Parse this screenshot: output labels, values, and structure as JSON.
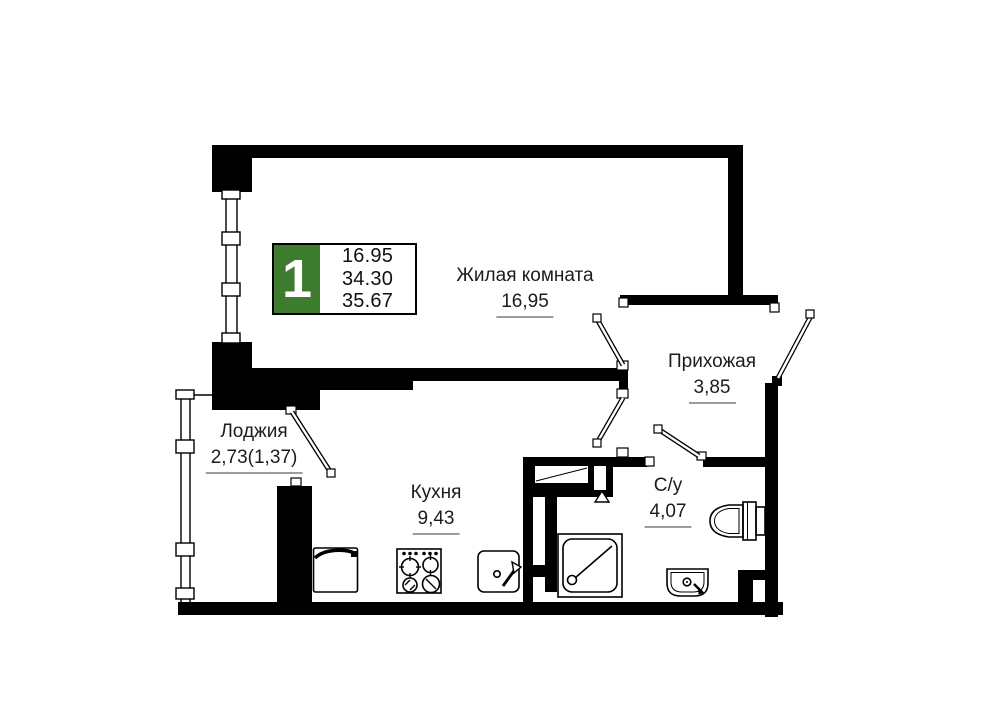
{
  "badge": {
    "room_count": "1",
    "areas": [
      "16.95",
      "34.30",
      "35.67"
    ],
    "accent_green": "#3d7c2f"
  },
  "rooms": {
    "living": {
      "name": "Жилая комната",
      "area": "16,95"
    },
    "hallway": {
      "name": "Прихожая",
      "area": "3,85"
    },
    "loggia": {
      "name": "Лоджия",
      "area": "2,73(1,37)"
    },
    "kitchen": {
      "name": "Кухня",
      "area": "9,43"
    },
    "bathroom": {
      "name": "С/у",
      "area": "4,07"
    }
  },
  "colors": {
    "wall": "#000000",
    "underline": "#9c9c9c",
    "background": "#ffffff"
  }
}
